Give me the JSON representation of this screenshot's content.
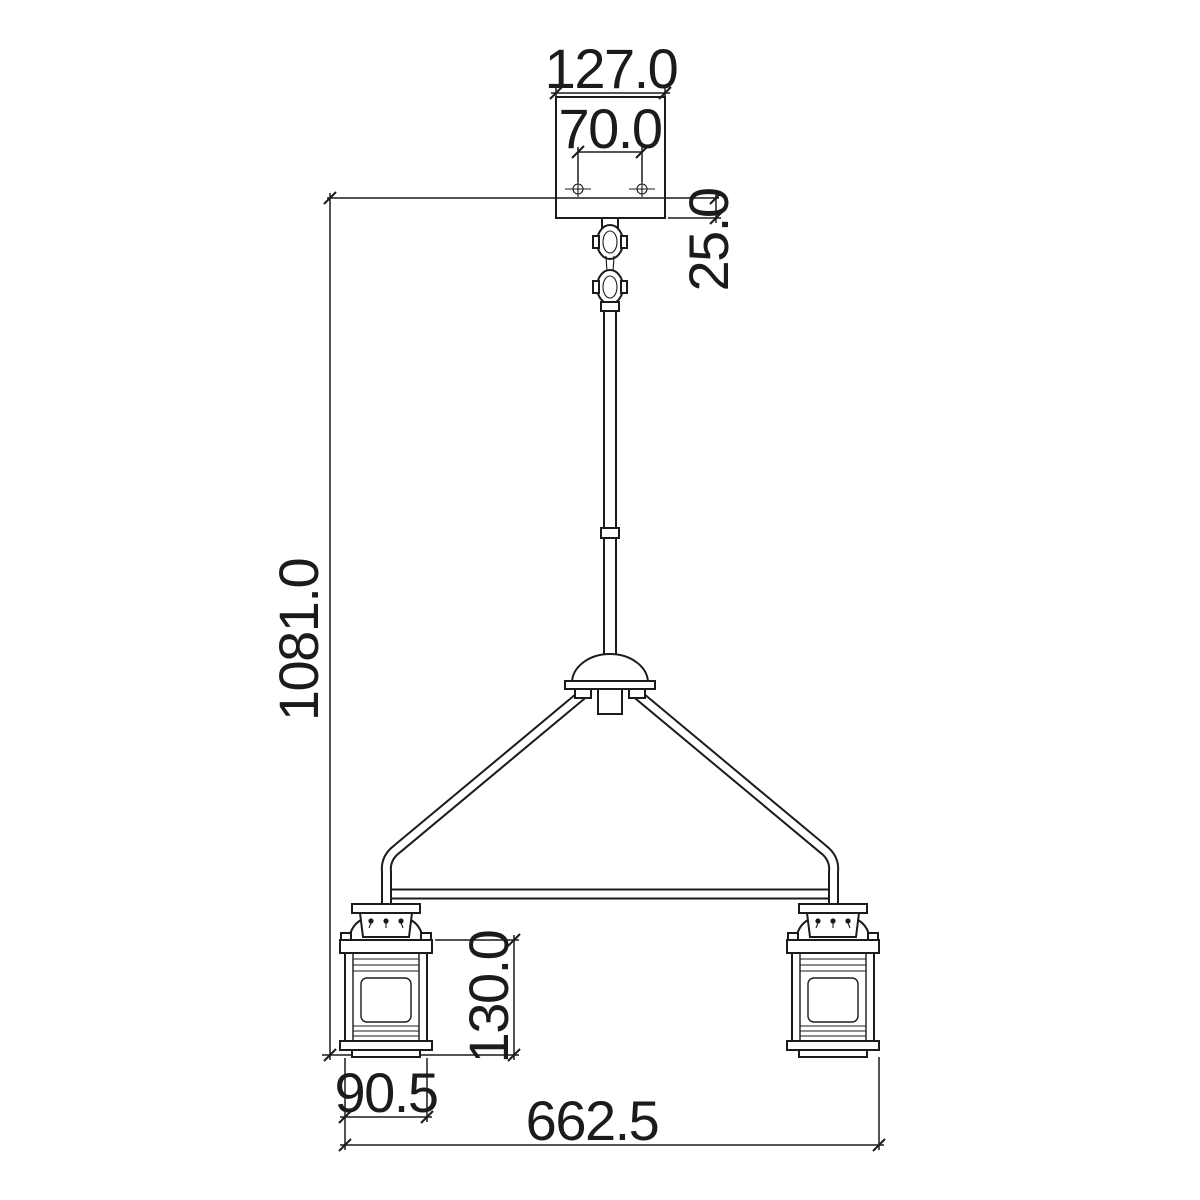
{
  "page": {
    "background": "#ffffff",
    "line_color": "#1b1b1b"
  },
  "drawing": {
    "type": "technical-dimension-drawing",
    "subject": "two-light linear island pendant with lantern shades, front elevation",
    "units_implied": "mm"
  },
  "dims": {
    "canopy_width": "127.0",
    "mount_hole_spacing": "70.0",
    "canopy_height": "25.0",
    "overall_height": "1081.0",
    "lantern_body_height": "130.0",
    "lantern_width": "90.5",
    "fixture_width": "662.5"
  }
}
